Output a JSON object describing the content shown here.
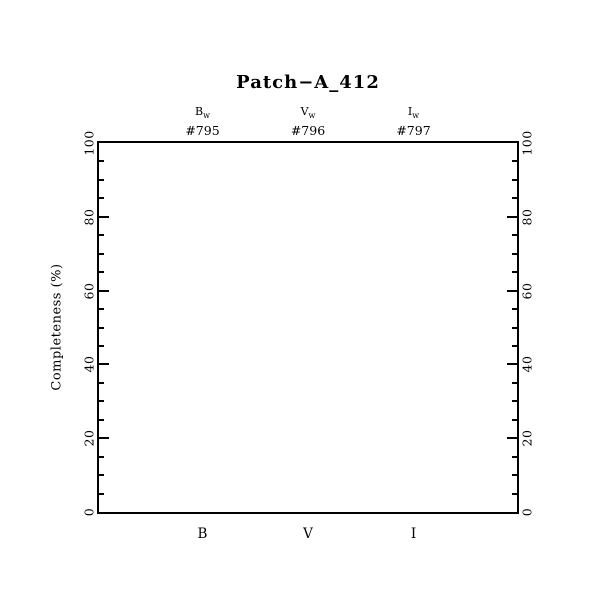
{
  "chart_data": {
    "type": "scatter",
    "title": "Patch−A_412",
    "xlabel": "",
    "ylabel": "Completeness (%)",
    "ylim": [
      0,
      100
    ],
    "yticks": [
      0,
      20,
      40,
      60,
      80,
      100
    ],
    "minor_tick_interval": 5,
    "x_categories": [
      "B",
      "V",
      "I"
    ],
    "bands": [
      {
        "name": "B",
        "sub": "w",
        "field_id": "#795"
      },
      {
        "name": "V",
        "sub": "w",
        "field_id": "#796"
      },
      {
        "name": "I",
        "sub": "w",
        "field_id": "#797"
      }
    ],
    "series": [],
    "grid": false,
    "legend": false,
    "plot_area_empty": true,
    "colors": {
      "foreground": "#000000",
      "background": "#ffffff"
    }
  }
}
